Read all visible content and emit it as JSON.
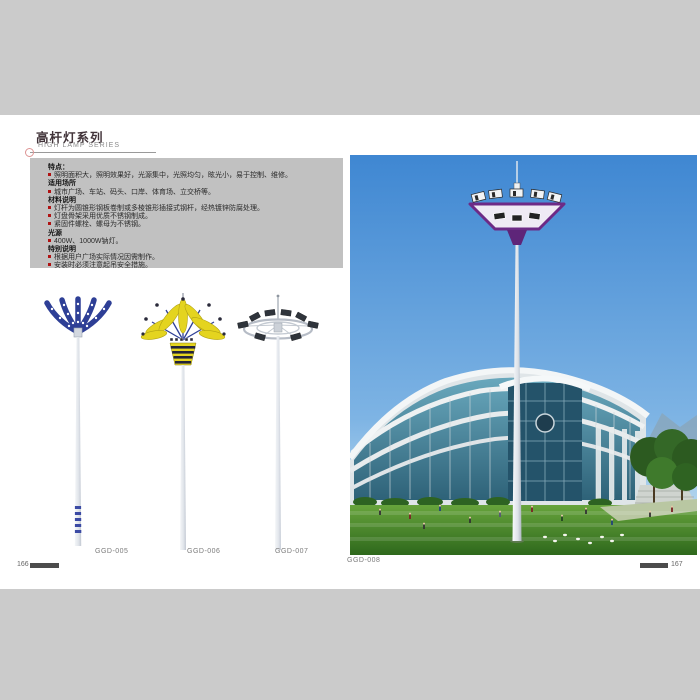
{
  "header": {
    "title_cn": "高杆灯系列",
    "subtitle_en": "HIGH LAMP SERIES"
  },
  "info_box": {
    "rows": [
      {
        "style": "heading",
        "text": "特点："
      },
      {
        "style": "bullet",
        "text": "照明面积大，照明效果好，光源集中，光照均匀，眩光小，易于控制、维修。"
      },
      {
        "style": "heading",
        "text": "适用场所"
      },
      {
        "style": "bullet",
        "text": "城市广场、车站、码头、口岸、体育场、立交桥等。"
      },
      {
        "style": "heading",
        "text": "材料说明"
      },
      {
        "style": "bullet",
        "text": "灯杆为圆锥形钢板卷制或多棱锥形插接式钢杆，经热镀锌防腐处理。"
      },
      {
        "style": "bullet",
        "text": "灯盘骨架采用优质不锈钢制成。"
      },
      {
        "style": "bullet",
        "text": "紧固件螺栓、螺母为不锈钢。"
      },
      {
        "style": "heading",
        "text": "光源"
      },
      {
        "style": "bullet",
        "text": "400W、1000W钠灯。"
      },
      {
        "style": "heading",
        "text": "特别说明"
      },
      {
        "style": "bullet",
        "text": "根据用户广场实际情况因需制作。"
      },
      {
        "style": "bullet",
        "text": "安装时必须注意起吊安全措施。"
      }
    ]
  },
  "products": [
    {
      "model": "GGD-005"
    },
    {
      "model": "GGD-006"
    },
    {
      "model": "GGD-007"
    }
  ],
  "photo": {
    "model": "GGD-008"
  },
  "footer": {
    "left_page": "166",
    "right_page": "167"
  },
  "icons": {
    "bullet-icon": "red-square",
    "ring-icon": "pink-circle-outline"
  },
  "colors": {
    "page_background": "#cbcbcb",
    "info_box_background": "#c1c1c1",
    "title_text": "#42343a",
    "bullet_red": "#b01212",
    "lamp_head_purple": "#6d2a86",
    "lamp_arms_blue": "#2e3f96",
    "lamp_crown_yellow": "#e4d41f",
    "photo_sky_blue": "#3f87d2",
    "photo_lawn_green": "#3a7a24",
    "footer_bar": "#4c4c4c"
  }
}
